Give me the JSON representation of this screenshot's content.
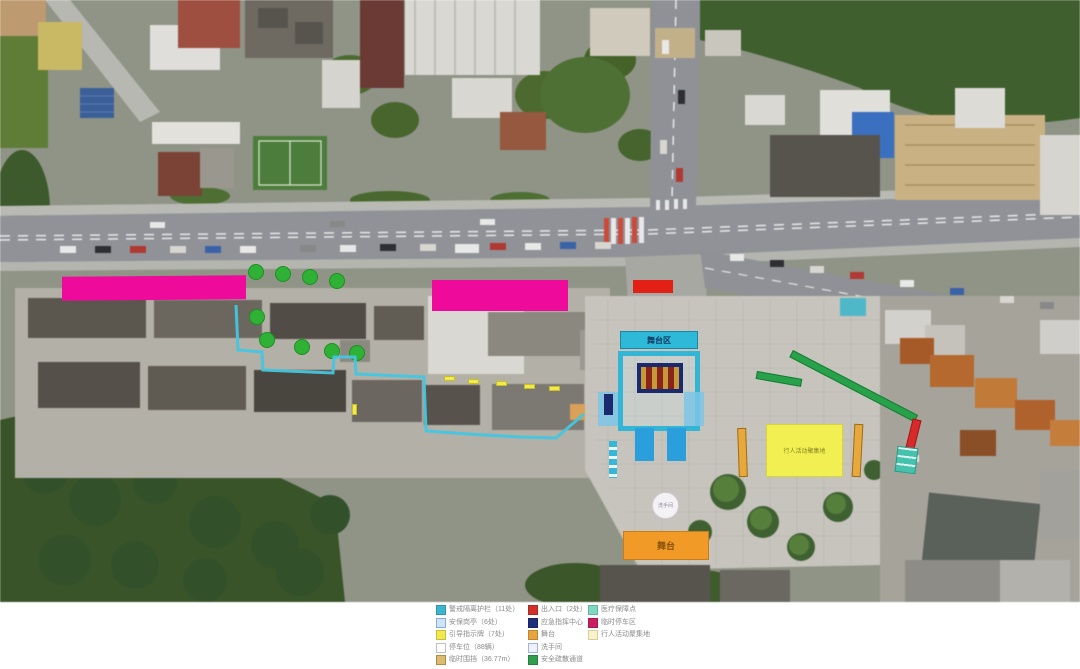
{
  "legend": {
    "columns": [
      {
        "items": [
          {
            "color": "#3ab7cf",
            "label": "警戒隔离护栏（11处）"
          },
          {
            "color": "#cfe4f6",
            "border": "#88aed4",
            "label": "安保岗亭（6处）"
          },
          {
            "color": "#f2e94e",
            "label": "引导指示牌（7处）"
          },
          {
            "color": "#ffffff",
            "border": "#c0c0c0",
            "label": "停车位（88辆）"
          },
          {
            "color": "#dcba74",
            "border": "#b08c3e",
            "label": "临时围挡（36.77m）"
          }
        ]
      },
      {
        "items": [
          {
            "color": "#d23129",
            "label": "出入口（2处）"
          },
          {
            "color": "#1d2f78",
            "label": "应急指挥中心"
          },
          {
            "color": "#e9a33d",
            "label": "舞台"
          },
          {
            "color": "#eef2fa",
            "border": "#9fb4d8",
            "label": "洗手间"
          },
          {
            "color": "#2f9e4e",
            "label": "安全疏散通道"
          }
        ]
      },
      {
        "items": [
          {
            "color": "#7ed8c4",
            "label": "医疗保障点"
          },
          {
            "color": "#cb1e5f",
            "label": "临时停车区"
          },
          {
            "color": "#f8f3cf",
            "border": "#d9cf8e",
            "label": "行人活动聚集地"
          }
        ]
      }
    ]
  },
  "map": {
    "labels": {
      "stage_zone": "舞台区",
      "pedestrian_zone": "行人活动聚集地",
      "stage": "舞台",
      "circle_marker": "洗手间"
    },
    "annotation_colors": {
      "barrier_cyan": "#3ab7cf",
      "parking_magenta": "#ee0a9a",
      "closure_red": "#e32015",
      "tree_green": "#2eb135",
      "route_cyan": "#45c6e0",
      "command_navy": "#1d2f78",
      "carpet_blue": "#2a9fdc",
      "zone_yellow": "#f2ef52",
      "stage_orange": "#f29a28",
      "fence_tan": "#e8a93c",
      "evacuation_green": "#28a24a",
      "medical_teal": "#45c2ae"
    }
  }
}
